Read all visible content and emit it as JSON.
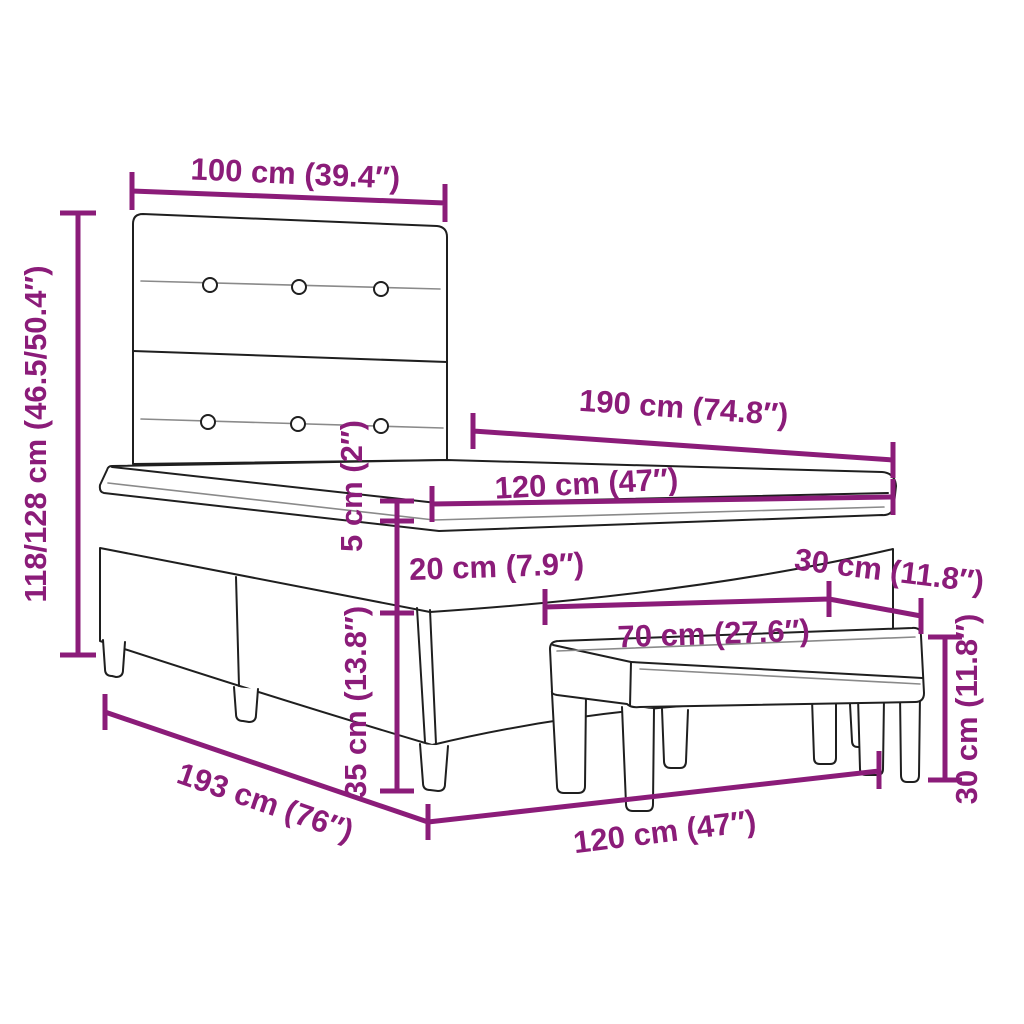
{
  "diagram": {
    "kind": "furniture-dimension-diagram",
    "objects": [
      "box-spring-bed-with-tufted-headboard",
      "upholstered-bench"
    ],
    "style": {
      "accent_color": "#8B1C79",
      "line_color": "#1F1F1F",
      "tuft_line_color": "#8A8A8A",
      "background": "#FFFFFF"
    }
  },
  "dims": {
    "headboard_width": {
      "label": "100 cm (39.4″)"
    },
    "total_height": {
      "label": "118/128 cm (46.5/50.4″)"
    },
    "mattress_length": {
      "label": "190 cm (74.8″)"
    },
    "mattress_width": {
      "label": "120 cm (47″)"
    },
    "topper_thickness": {
      "label": "5 cm (2″)"
    },
    "mattress_thickness": {
      "label": "20 cm (7.9″)"
    },
    "base_height": {
      "label": "35 cm (13.8″)"
    },
    "frame_length": {
      "label": "193 cm (76″)"
    },
    "frame_width": {
      "label": "120 cm (47″)"
    },
    "bench_length": {
      "label": "70 cm (27.6″)"
    },
    "bench_depth": {
      "label": "30 cm (11.8″)"
    },
    "bench_height": {
      "label": "30 cm (11.8″)"
    }
  }
}
